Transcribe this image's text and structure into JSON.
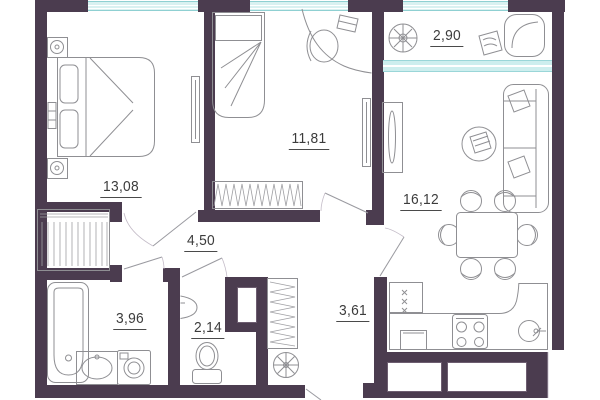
{
  "plan": {
    "type": "apartment-floor-plan",
    "rooms": [
      {
        "id": "bedroom",
        "area": "13,08"
      },
      {
        "id": "room-2",
        "area": "11,81"
      },
      {
        "id": "balcony",
        "area": "2,90"
      },
      {
        "id": "living",
        "area": "16,12"
      },
      {
        "id": "corridor",
        "area": "4,50"
      },
      {
        "id": "bathroom",
        "area": "3,96"
      },
      {
        "id": "wc",
        "area": "2,14"
      },
      {
        "id": "hall",
        "area": "3,61"
      }
    ],
    "colors": {
      "wall": "#4b3c4f",
      "glass": "#cdeeee",
      "glass_border": "#8fd0d2",
      "furniture_line": "#8f8f93",
      "label": "#3c3c3c",
      "bg": "#ffffff"
    }
  }
}
